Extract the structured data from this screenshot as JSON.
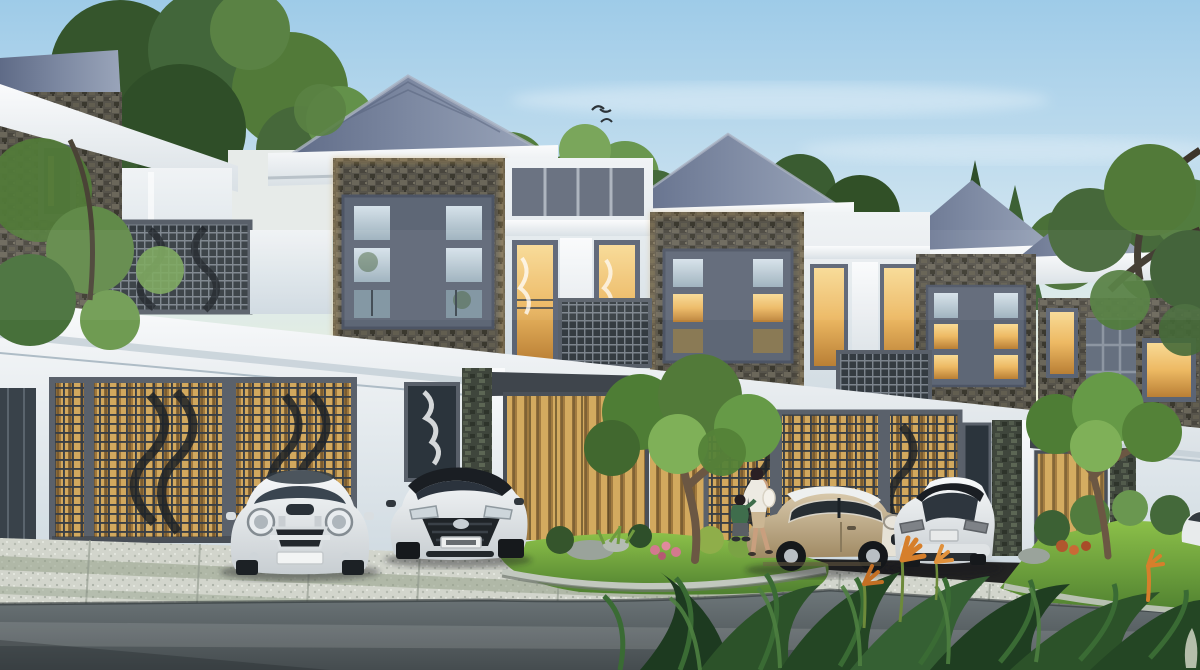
{
  "scene": {
    "type": "architectural-render",
    "description": "Photorealistic rendering of a row of modern two-storey townhouses with grey hip roofs, stone-clad window towers, warm-lit interiors, lattice garage screens, landscaped gardens and a curved asphalt road in the foreground.",
    "houses": {
      "count_visible": 5,
      "features": [
        "grey hip roof",
        "white cornice bands",
        "stone veneer tower with 3x3 grid window",
        "balcony lattice fence",
        "garage lattice screens with warm glow",
        "golden wood-slat entrance doors",
        "stone columns"
      ]
    },
    "vehicles": [
      {
        "name": "white-mini-front",
        "color_key": "car_white",
        "view": "front"
      },
      {
        "name": "white-hyundai-i20",
        "color_key": "car_white",
        "view": "front-three-quarter",
        "roof": "black"
      },
      {
        "name": "beige-mini-side",
        "color_key": "car_beige",
        "view": "side",
        "roof": "white"
      },
      {
        "name": "white-hatchback-rear",
        "color_key": "car_white",
        "view": "rear-three-quarter",
        "roof": "black"
      },
      {
        "name": "white-car-edge",
        "color_key": "car_white",
        "view": "partial"
      }
    ],
    "people": [
      {
        "name": "woman",
        "top": "white jacket",
        "bottom": "beige skirt"
      },
      {
        "name": "child",
        "top": "green shirt",
        "pose": "crouching"
      }
    ],
    "nature": [
      "hillside trees behind houses",
      "plumeria garden tree",
      "grass island with rocks and pink flowers",
      "right garden with tree and shrubs",
      "foreground tropical plants with orange flowers",
      "two birds in sky"
    ]
  },
  "palette": {
    "sky_top": "#9ecbe8",
    "sky_mid": "#cfe4f0",
    "sky_horizon": "#f2f3da",
    "roof_dark": "#5f6b87",
    "roof_light": "#9aa5ba",
    "trim_white": "#f3f6f7",
    "wall_white": "#e9eef1",
    "wall_shadow": "#c9d5dd",
    "stone_dark": "#57544b",
    "stone_green": "#3f463c",
    "frame_gray": "#5e6776",
    "glass_warm": "#edb963",
    "glass_cool": "#c3d4de",
    "wood_slat": "#c9a057",
    "lattice_dark": "#383e45",
    "lawn_light": "#8cc049",
    "lawn_dark": "#4f8030",
    "foliage_dark": "#35552c",
    "foliage_mid": "#527a39",
    "foliage_light": "#79a352",
    "road_light": "#6e777a",
    "road_dark": "#454c4f",
    "paving_light": "#d2d5cc",
    "paving_green": "#93a089",
    "curb": "#c2c8bf",
    "car_white": "#eef0f1",
    "car_beige": "#c3b194",
    "car_roof_black": "#1a1e23",
    "grille_black": "#23282d",
    "flower_orange": "#d67f2b",
    "flower_pink": "#d3798f",
    "skin": "#c99f7e",
    "woman_jacket": "#edeae2",
    "woman_skirt": "#cbb693",
    "child_shirt": "#3f6d4c",
    "bird": "#2c3338",
    "trunk": "#6b5743",
    "rock_gray": "#9aa39b"
  }
}
